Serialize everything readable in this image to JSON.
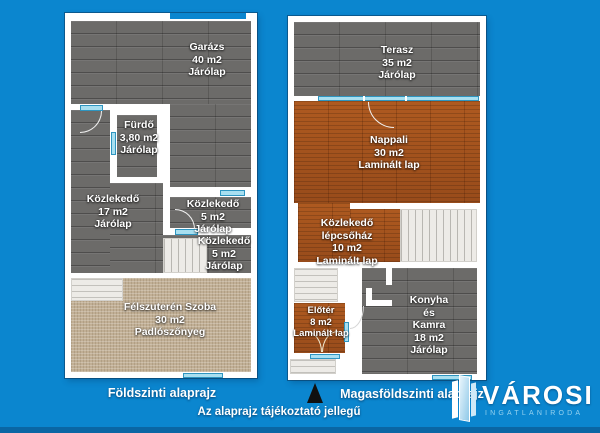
{
  "plans": [
    {
      "caption": "Földszinti alaprajz",
      "rooms": [
        {
          "lines": [
            "Garázs",
            "40 m2",
            "Járólap"
          ]
        },
        {
          "lines": [
            "Fürdő",
            "3,80 m2",
            "Járólap"
          ]
        },
        {
          "lines": [
            "Közlekedő",
            "17 m2",
            "Járólap"
          ]
        },
        {
          "lines": [
            "Közlekedő",
            "5 m2",
            "Járólap"
          ]
        },
        {
          "lines": [
            "Közlekedő",
            "5 m2",
            "Járólap"
          ]
        },
        {
          "lines": [
            "Félszuterén Szoba",
            "30 m2",
            "Padlószőnyeg"
          ]
        }
      ]
    },
    {
      "caption": "Magasföldszinti alaprajz",
      "rooms": [
        {
          "lines": [
            "Terasz",
            "35 m2",
            "Járólap"
          ]
        },
        {
          "lines": [
            "Nappali",
            "30 m2",
            "Laminált lap"
          ]
        },
        {
          "lines": [
            "Közlekedő",
            "lépcsőház",
            "10 m2",
            "Laminált lap"
          ]
        },
        {
          "lines": [
            "Előtér",
            "8 m2",
            "Laminált lap"
          ]
        },
        {
          "lines": [
            "Konyha",
            "és",
            "Kamra",
            "18 m2",
            "Járólap"
          ]
        }
      ]
    }
  ],
  "footer": {
    "disclaimer": "Az alaprajz tájékoztató jellegű"
  },
  "logo": {
    "brand": "VÁROSI",
    "subtitle": "INGATLANIRODA"
  },
  "colors": {
    "background": "#0b86cf",
    "bottom_bar": "#0a66a4",
    "wall": "#ffffff",
    "tile_gray": "#6c6b69",
    "wood": "#a5521d",
    "carpet": "#c1af95",
    "window_cyan": "#a8dff0",
    "north_arrow": "#101010"
  }
}
